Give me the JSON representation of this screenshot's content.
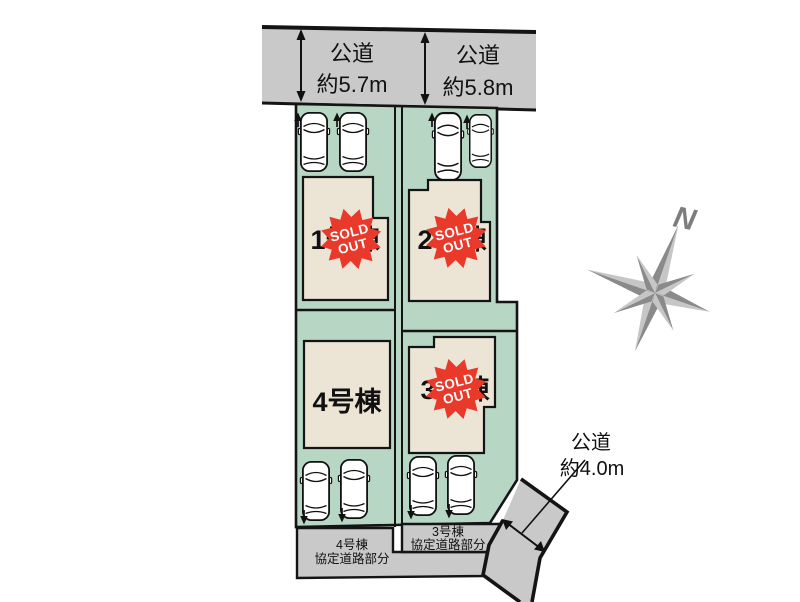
{
  "roads": {
    "top_left": {
      "name": "公道",
      "width": "約5.7m"
    },
    "top_right": {
      "name": "公道",
      "width": "約5.8m"
    },
    "bottom_right": {
      "name": "公道",
      "width": "約4.0m"
    }
  },
  "lots": [
    {
      "label": "1号棟",
      "sold_out": true
    },
    {
      "label": "2号棟",
      "sold_out": true
    },
    {
      "label": "3号棟",
      "sold_out": true
    },
    {
      "label": "4号棟",
      "sold_out": false
    }
  ],
  "sold_stamp": {
    "line1": "SOLD",
    "line2": "OUT"
  },
  "agreement_areas": [
    {
      "line1": "4号棟",
      "line2": "協定道路部分"
    },
    {
      "line1": "3号棟",
      "line2": "協定道路部分"
    }
  ],
  "compass": {
    "label": "N"
  },
  "colors": {
    "parcel_green": "#b7d6c4",
    "road_gray": "#c9c9c9",
    "building_beige": "#ece4d4",
    "stamp_red": "#e8392b",
    "compass_dark": "#8a8a8a",
    "compass_light": "#c6c6c6",
    "outline_black": "#141414"
  }
}
